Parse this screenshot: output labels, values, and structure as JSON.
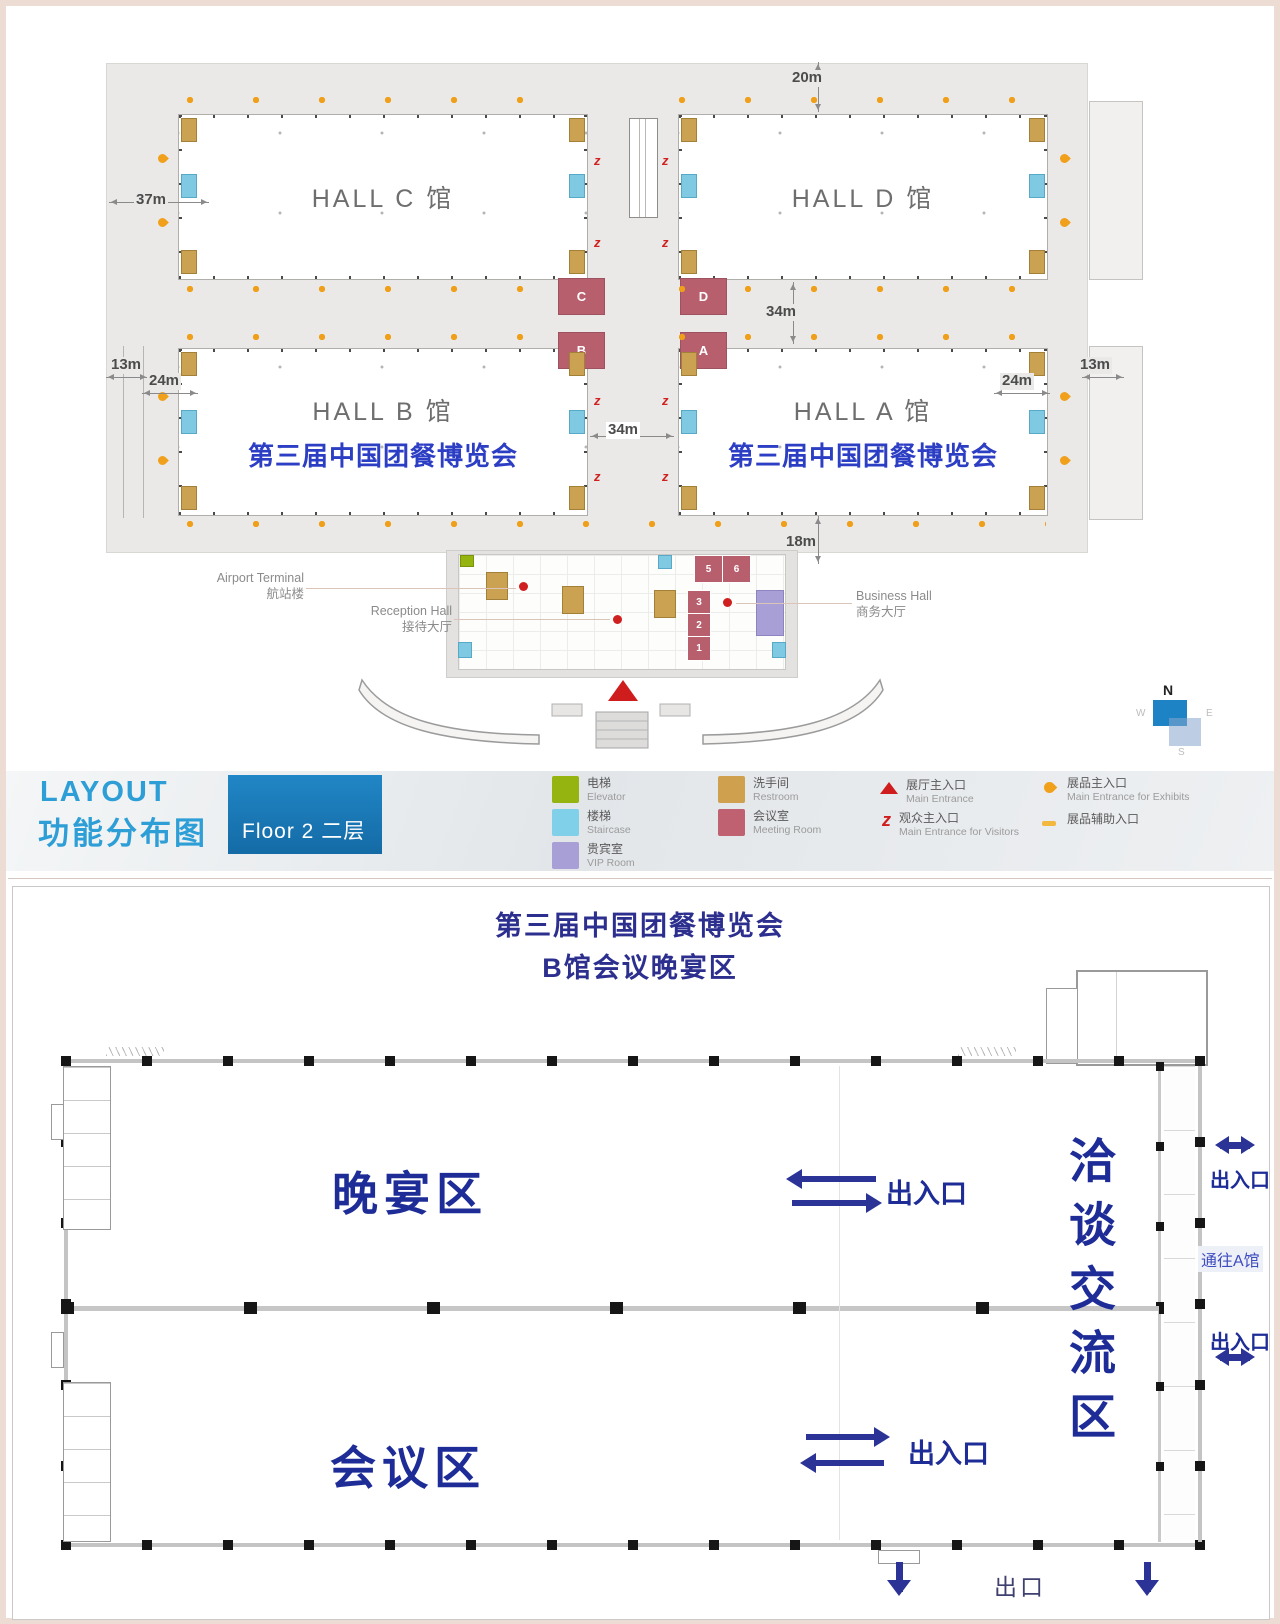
{
  "top": {
    "halls": {
      "c": "HALL C 馆",
      "d": "HALL D 馆",
      "b": "HALL B 馆",
      "a": "HALL A 馆",
      "expo_banner": "第三届中国团餐博览会"
    },
    "meeting_rooms": {
      "c": "C",
      "b": "B",
      "d": "D",
      "a": "A"
    },
    "dims": {
      "top_20": "20m",
      "left_37": "37m",
      "left_13": "13m",
      "left_24": "24m",
      "right_24": "24m",
      "right_13": "13m",
      "gap_34v": "34m",
      "gap_34h": "34m",
      "bottom_18": "18m"
    },
    "callouts": {
      "airport_en": "Airport Terminal",
      "airport_zh": "航站楼",
      "reception_en": "Reception Hall",
      "reception_zh": "接待大厅",
      "business_en": "Business Hall",
      "business_zh": "商务大厅"
    },
    "reception_rooms": {
      "r5": "5",
      "r6": "6",
      "r3": "3",
      "r2": "2",
      "r1": "1"
    },
    "compass": {
      "n": "N",
      "w": "W",
      "e": "E",
      "s": "S"
    },
    "footer": {
      "title_en": "LAYOUT",
      "title_zh": "功能分布图",
      "floor_badge": "Floor 2 二层",
      "legend": [
        {
          "zh": "电梯",
          "en": "Elevator",
          "color": "#96b40f"
        },
        {
          "zh": "楼梯",
          "en": "Staircase",
          "color": "#7fd0e8"
        },
        {
          "zh": "贵宾室",
          "en": "VIP Room",
          "color": "#a79fd6"
        },
        {
          "zh": "洗手间",
          "en": "Restroom",
          "color": "#cfa14e"
        },
        {
          "zh": "会议室",
          "en": "Meeting Room",
          "color": "#bf6170"
        },
        {
          "zh": "展厅主入口",
          "en": "Main Entrance",
          "color": "#cf1d1d"
        },
        {
          "zh": "观众主入口",
          "en": "Main Entrance for Visitors",
          "color": "#cf1d1d"
        },
        {
          "zh": "展品主入口",
          "en": "Main Entrance for Exhibits",
          "color": "#f0a01a"
        },
        {
          "zh": "展品辅助入口",
          "en": "",
          "color": "#f3b93e"
        }
      ]
    }
  },
  "bottom": {
    "title_line1": "第三届中国团餐博览会",
    "title_line2": "B馆会议晚宴区",
    "dinner_area": "晚宴区",
    "conference_area": "会议区",
    "negotiation_area": "洽谈交流区",
    "entrance_exit": "出入口",
    "to_hall_a": "通往A馆",
    "exit": "出口"
  }
}
